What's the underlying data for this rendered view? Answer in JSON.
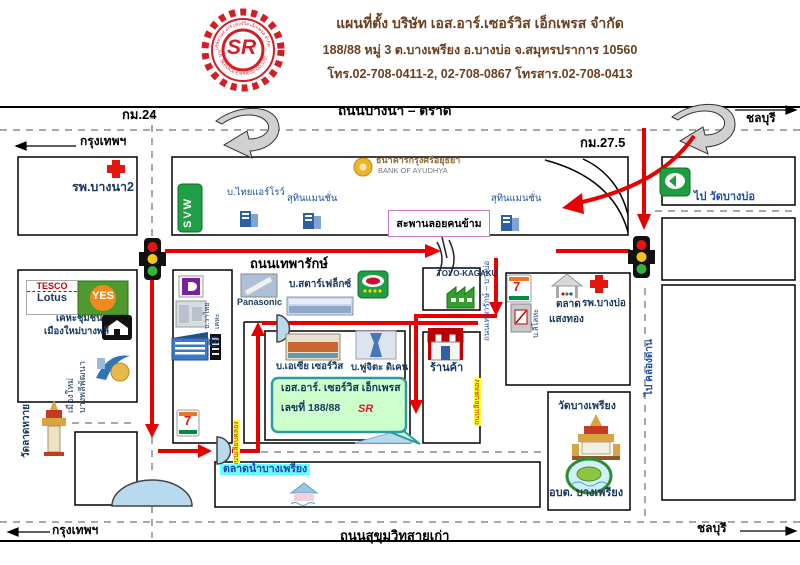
{
  "colors": {
    "route_red": "#E60000",
    "road_line": "#000000",
    "dash_gray": "#8C8C8C",
    "label_navy": "#17375E",
    "label_blue": "#1F4FA0",
    "header_brown": "#6B3F20",
    "logo_red": "#D21F26",
    "bubble_green": "#CCFFCC",
    "canal_blue": "#B8D9EE",
    "highlight_yellow": "#FFFF33",
    "highlight_cyan": "#66FFFF"
  },
  "header": {
    "line1": "แผนที่ตั้ง บริษัท เอส.อาร์.เซอร์วิส เอ็กเพรส จำกัด",
    "line2": "188/88  หมู่ 3  ต.บางเพรียง  อ.บางบ่อ  จ.สมุทรปราการ  10560",
    "line3": "โทร.02-708-0411-2, 02-708-0867   โทรสาร.02-708-0413",
    "logo": {
      "letters": "SR",
      "ring_top": "บริษัท เอส.อาร์.เซอร์วิส เอ็กเพรส จำกัด",
      "ring_bottom": "S.R. SERVICE EXPRESS CO.,LTD."
    }
  },
  "roads": {
    "bangna_trad": "ถนนบางนา – ตราด",
    "km24": "กม.24",
    "km275": "กม.27.5",
    "thepharak": "ถนนเทพารักษ์",
    "sukhumvit_old": "ถนนสุขุมวิทสายเก่า",
    "bangkok_top": "กรุงเทพฯ",
    "chonburi_top": "ชลบุรี",
    "bangkok_bottom": "กรุงเทพฯ",
    "chonburi_bottom": "ชลบุรี",
    "to_wat_bangbo": "ไป วัดบางบ่อ",
    "to_khlong_dan": "ไป คลองด่าน",
    "thepharak_bangbo": "ถนนเทพารักษ์ – บางบ่อ",
    "canal_label_left": "ถนนเลียบคลอง",
    "canal_label_right": "ถนนเลียบคลอง"
  },
  "places": {
    "hospital_bangna": "รพ.บางนา2",
    "svw": "SVW",
    "thai_arrow": "บ.ไทยแอร์โรว์",
    "bank_th": "ธนาคารกรุงศรีอยุธยา",
    "bank_en": "BANK OF AYUDHYA",
    "suthin_left": "สุทินแมนชั่น",
    "suthin_right": "สุทินแมนชั่น",
    "footbridge": "สะพานลอยคนข้าม",
    "tesco": "TESCO",
    "lotus": "Lotus",
    "yes": "YES",
    "khetha_line1": "เคหะชุมชน",
    "khetha_line2": "เมืองใหม่บางพลี",
    "muang_mai_line1": "เมืองใหม่",
    "muang_mai_line2": "บางพลีพัฒนา",
    "wat_lat_wai": "วัดลาดหวาย",
    "panasonic": "Panasonic",
    "starflex": "บ.สตาร์เฟล็กซ์",
    "company_small_1": "บ.วาไทย",
    "company_small_2": "เคหะ",
    "at_logo": "@",
    "seven_left": "7",
    "seven_right": "7",
    "asia_service": "บ.เอเซีย เซอร์วิส",
    "fujita": "บ.ฟูจิตะ ดิเคน",
    "sr_line1": "เอส.อาร์. เซอร์วิส เอ็กเพรส",
    "sr_line2": "เลขที่ 188/88",
    "sr_letters": "SR",
    "shop": "ร้านค้า",
    "toyo": "TOYO-KAGAKU",
    "metal_co": "บ.ลีโลหะ",
    "talat_line1": "ตลาด",
    "talat_line2": "แสงทอง",
    "hospital_bangbo": "รพ.บางบ่อ",
    "wat_bangphriang": "วัดบางเพรียง",
    "obt": "อบต. บางเพรียง",
    "floating_market": "ตลาดน้ำบางเพรียง"
  }
}
